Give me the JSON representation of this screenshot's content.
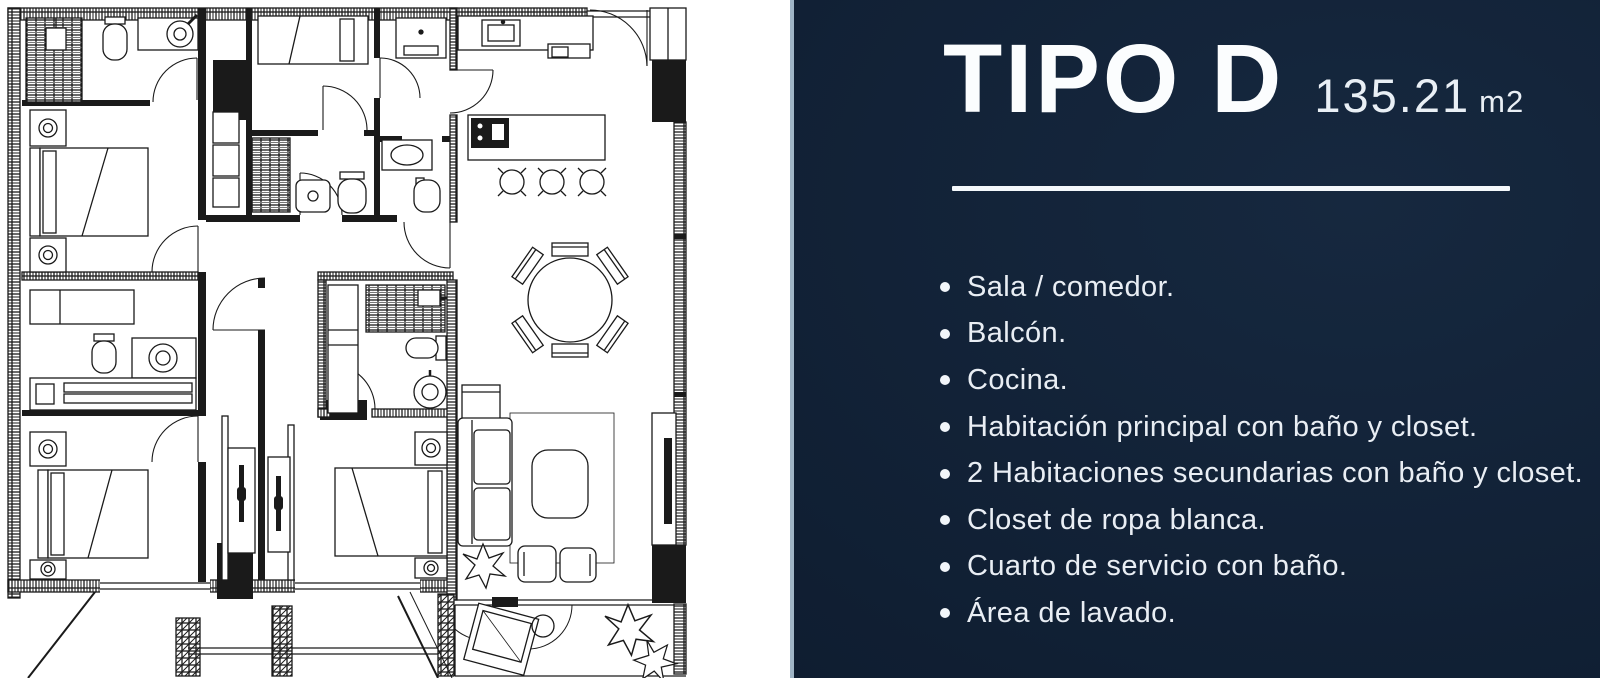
{
  "panel": {
    "title": "TIPO D",
    "area": {
      "value": "135.21",
      "unit": "m2"
    },
    "features": [
      "Sala / comedor.",
      "Balcón.",
      "Cocina.",
      "Habitación principal con baño y closet.",
      "2 Habitaciones secundarias con baño y closet.",
      "Closet de ropa blanca.",
      "Cuarto de servicio con baño.",
      "Área de lavado."
    ],
    "colors": {
      "background_dark": "#0e1c2f",
      "background": "#16283f",
      "text": "#eef3f7",
      "divider": "#f4f8fb",
      "edge": "#b9cfdf"
    }
  },
  "floor_plan": {
    "type": "apartment-floor-plan",
    "paper": "#ffffff",
    "ink": "#1a1a1a"
  }
}
